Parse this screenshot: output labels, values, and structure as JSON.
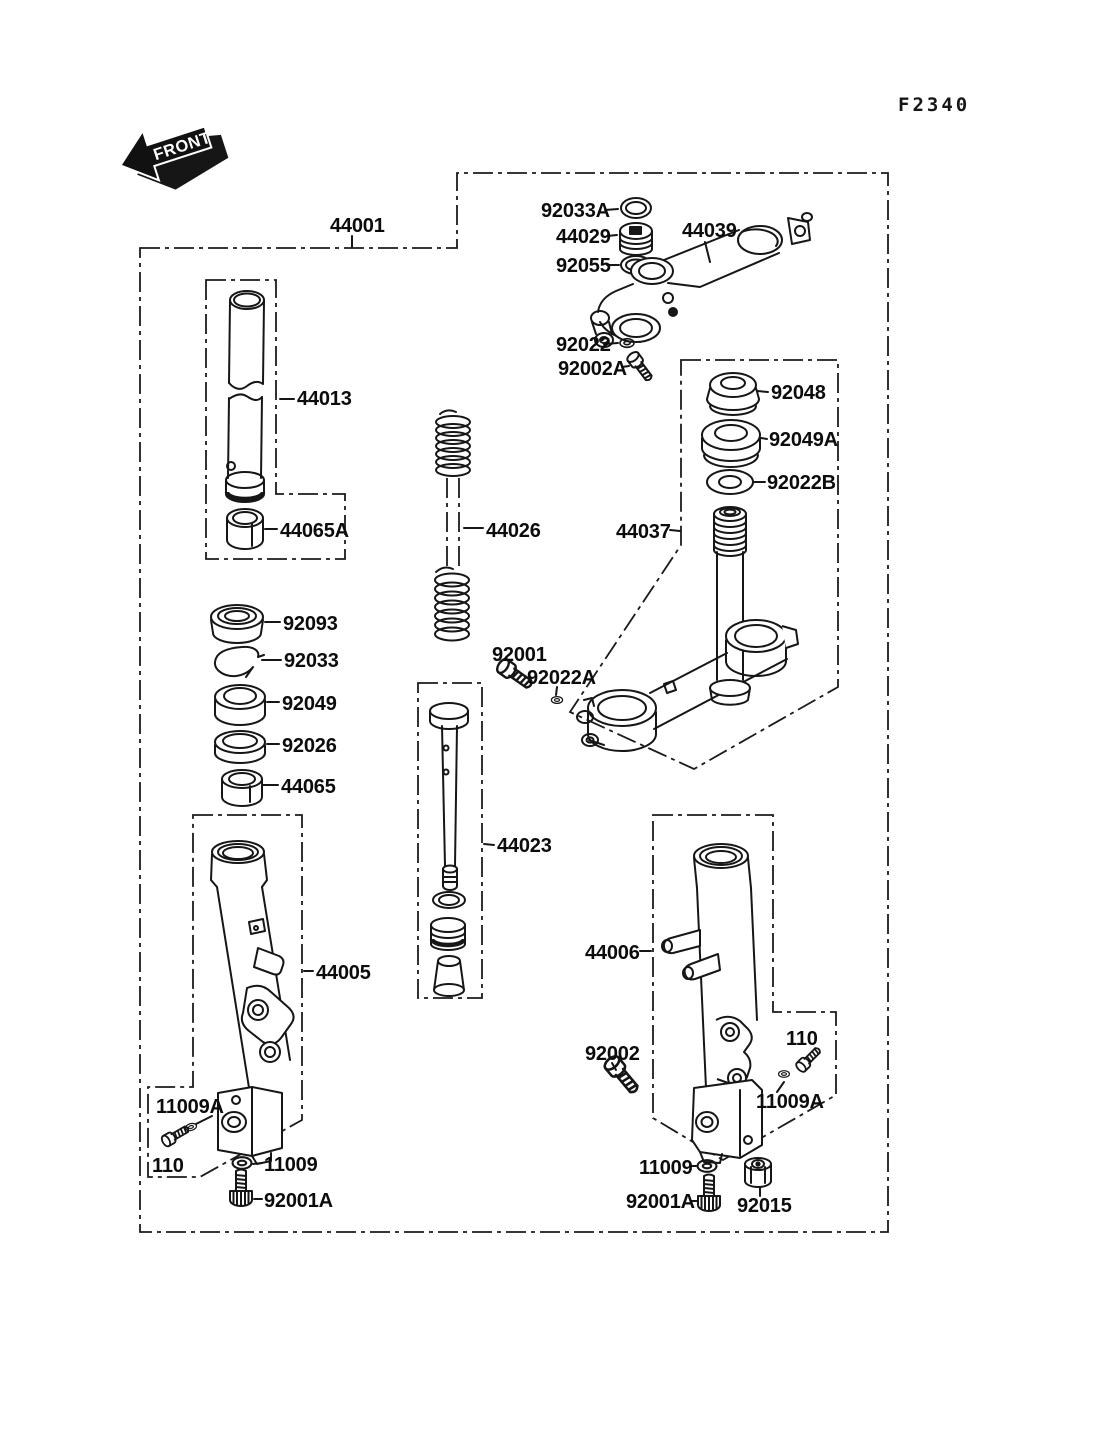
{
  "header": {
    "figure_code": "F2340"
  },
  "front_marker": {
    "label": "FRONT"
  },
  "callouts": {
    "44001": "44001",
    "44013": "44013",
    "44065A": "44065A",
    "92093": "92093",
    "92033": "92033",
    "92049": "92049",
    "92026": "92026",
    "44065": "44065",
    "44026": "44026",
    "92033A": "92033A",
    "44029": "44029",
    "92055": "92055",
    "44039": "44039",
    "92022": "92022",
    "92002A": "92002A",
    "92048": "92048",
    "92049A": "92049A",
    "92022B": "92022B",
    "44037": "44037",
    "92001": "92001",
    "92022A": "92022A",
    "44023": "44023",
    "44005": "44005",
    "44006": "44006",
    "92002": "92002",
    "110": "110",
    "11009A": "11009A",
    "11009": "11009",
    "92001A": "92001A",
    "92015": "92015"
  }
}
